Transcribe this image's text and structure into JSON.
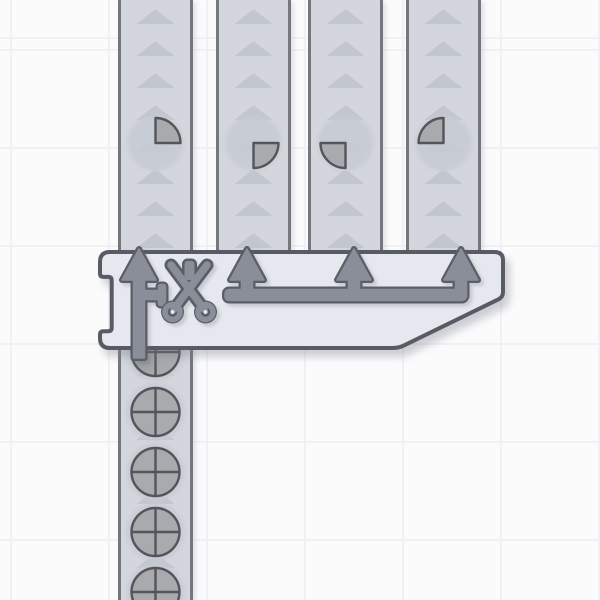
{
  "app": {
    "name": "shape-factory-game",
    "view": "factory-floor"
  },
  "colors": {
    "background": "#fbfbfc",
    "grid_line": "#f0f1f4",
    "belt": "#d3d6dc",
    "belt_border": "#75777f",
    "belt_arrow": "#c2c6cd",
    "item_bg": "#c7cbd4",
    "shape_fill": "#a8aaad",
    "shape_outline": "#53555b",
    "machine_body": "#e6e8ef",
    "machine_outline": "#585b63",
    "icon_fill": "#8a8e99",
    "icon_outline": "#5b5e66"
  },
  "grid": {
    "cell": 98,
    "line_width": 2,
    "offset_x": 10,
    "offset_y": 49
  },
  "belts": [
    {
      "id": "belt-output-1",
      "x": 118,
      "y": 0,
      "width": 75,
      "height": 252,
      "direction": "up"
    },
    {
      "id": "belt-output-2",
      "x": 216,
      "y": 0,
      "width": 75,
      "height": 252,
      "direction": "up"
    },
    {
      "id": "belt-output-3",
      "x": 308,
      "y": 0,
      "width": 75,
      "height": 252,
      "direction": "up"
    },
    {
      "id": "belt-output-4",
      "x": 406,
      "y": 0,
      "width": 75,
      "height": 252,
      "direction": "up"
    },
    {
      "id": "belt-input",
      "x": 118,
      "y": 348,
      "width": 75,
      "height": 252,
      "direction": "up"
    }
  ],
  "belt_arrow": {
    "spacing": 32,
    "half_width": 19,
    "height": 15,
    "phase": 9
  },
  "items": [
    {
      "belt": "belt-output-1",
      "shape": "quarter-top-right",
      "cx": 155.5,
      "cy": 143
    },
    {
      "belt": "belt-output-2",
      "shape": "quarter-bottom-right",
      "cx": 253.5,
      "cy": 143
    },
    {
      "belt": "belt-output-3",
      "shape": "quarter-bottom-left",
      "cx": 345.5,
      "cy": 143
    },
    {
      "belt": "belt-output-4",
      "shape": "quarter-top-left",
      "cx": 443.5,
      "cy": 143
    },
    {
      "belt": "belt-input",
      "shape": "circle-full",
      "cx": 155.5,
      "cy": 352
    },
    {
      "belt": "belt-input",
      "shape": "circle-full",
      "cx": 155.5,
      "cy": 412
    },
    {
      "belt": "belt-input",
      "shape": "circle-full",
      "cx": 155.5,
      "cy": 472
    },
    {
      "belt": "belt-input",
      "shape": "circle-full",
      "cx": 155.5,
      "cy": 532
    },
    {
      "belt": "belt-input",
      "shape": "circle-full",
      "cx": 155.5,
      "cy": 592
    }
  ],
  "shape_radius": {
    "quarter": 25,
    "circle": 24,
    "item_bg": 28,
    "item_bg_circle": 29
  },
  "machine": {
    "name": "cutter-quad",
    "icon": "scissors-icon",
    "x": 100,
    "y": 252,
    "right": 503,
    "bottom": 348,
    "outputs_x": [
      139,
      247,
      354,
      461
    ],
    "input_x": 139,
    "input_stub_bottom": 358,
    "pipe_top": 289.5,
    "pipe_height": 11,
    "pipe_left": 225,
    "pipe_right": 466,
    "icon_center": {
      "x": 189,
      "y": 288
    }
  }
}
